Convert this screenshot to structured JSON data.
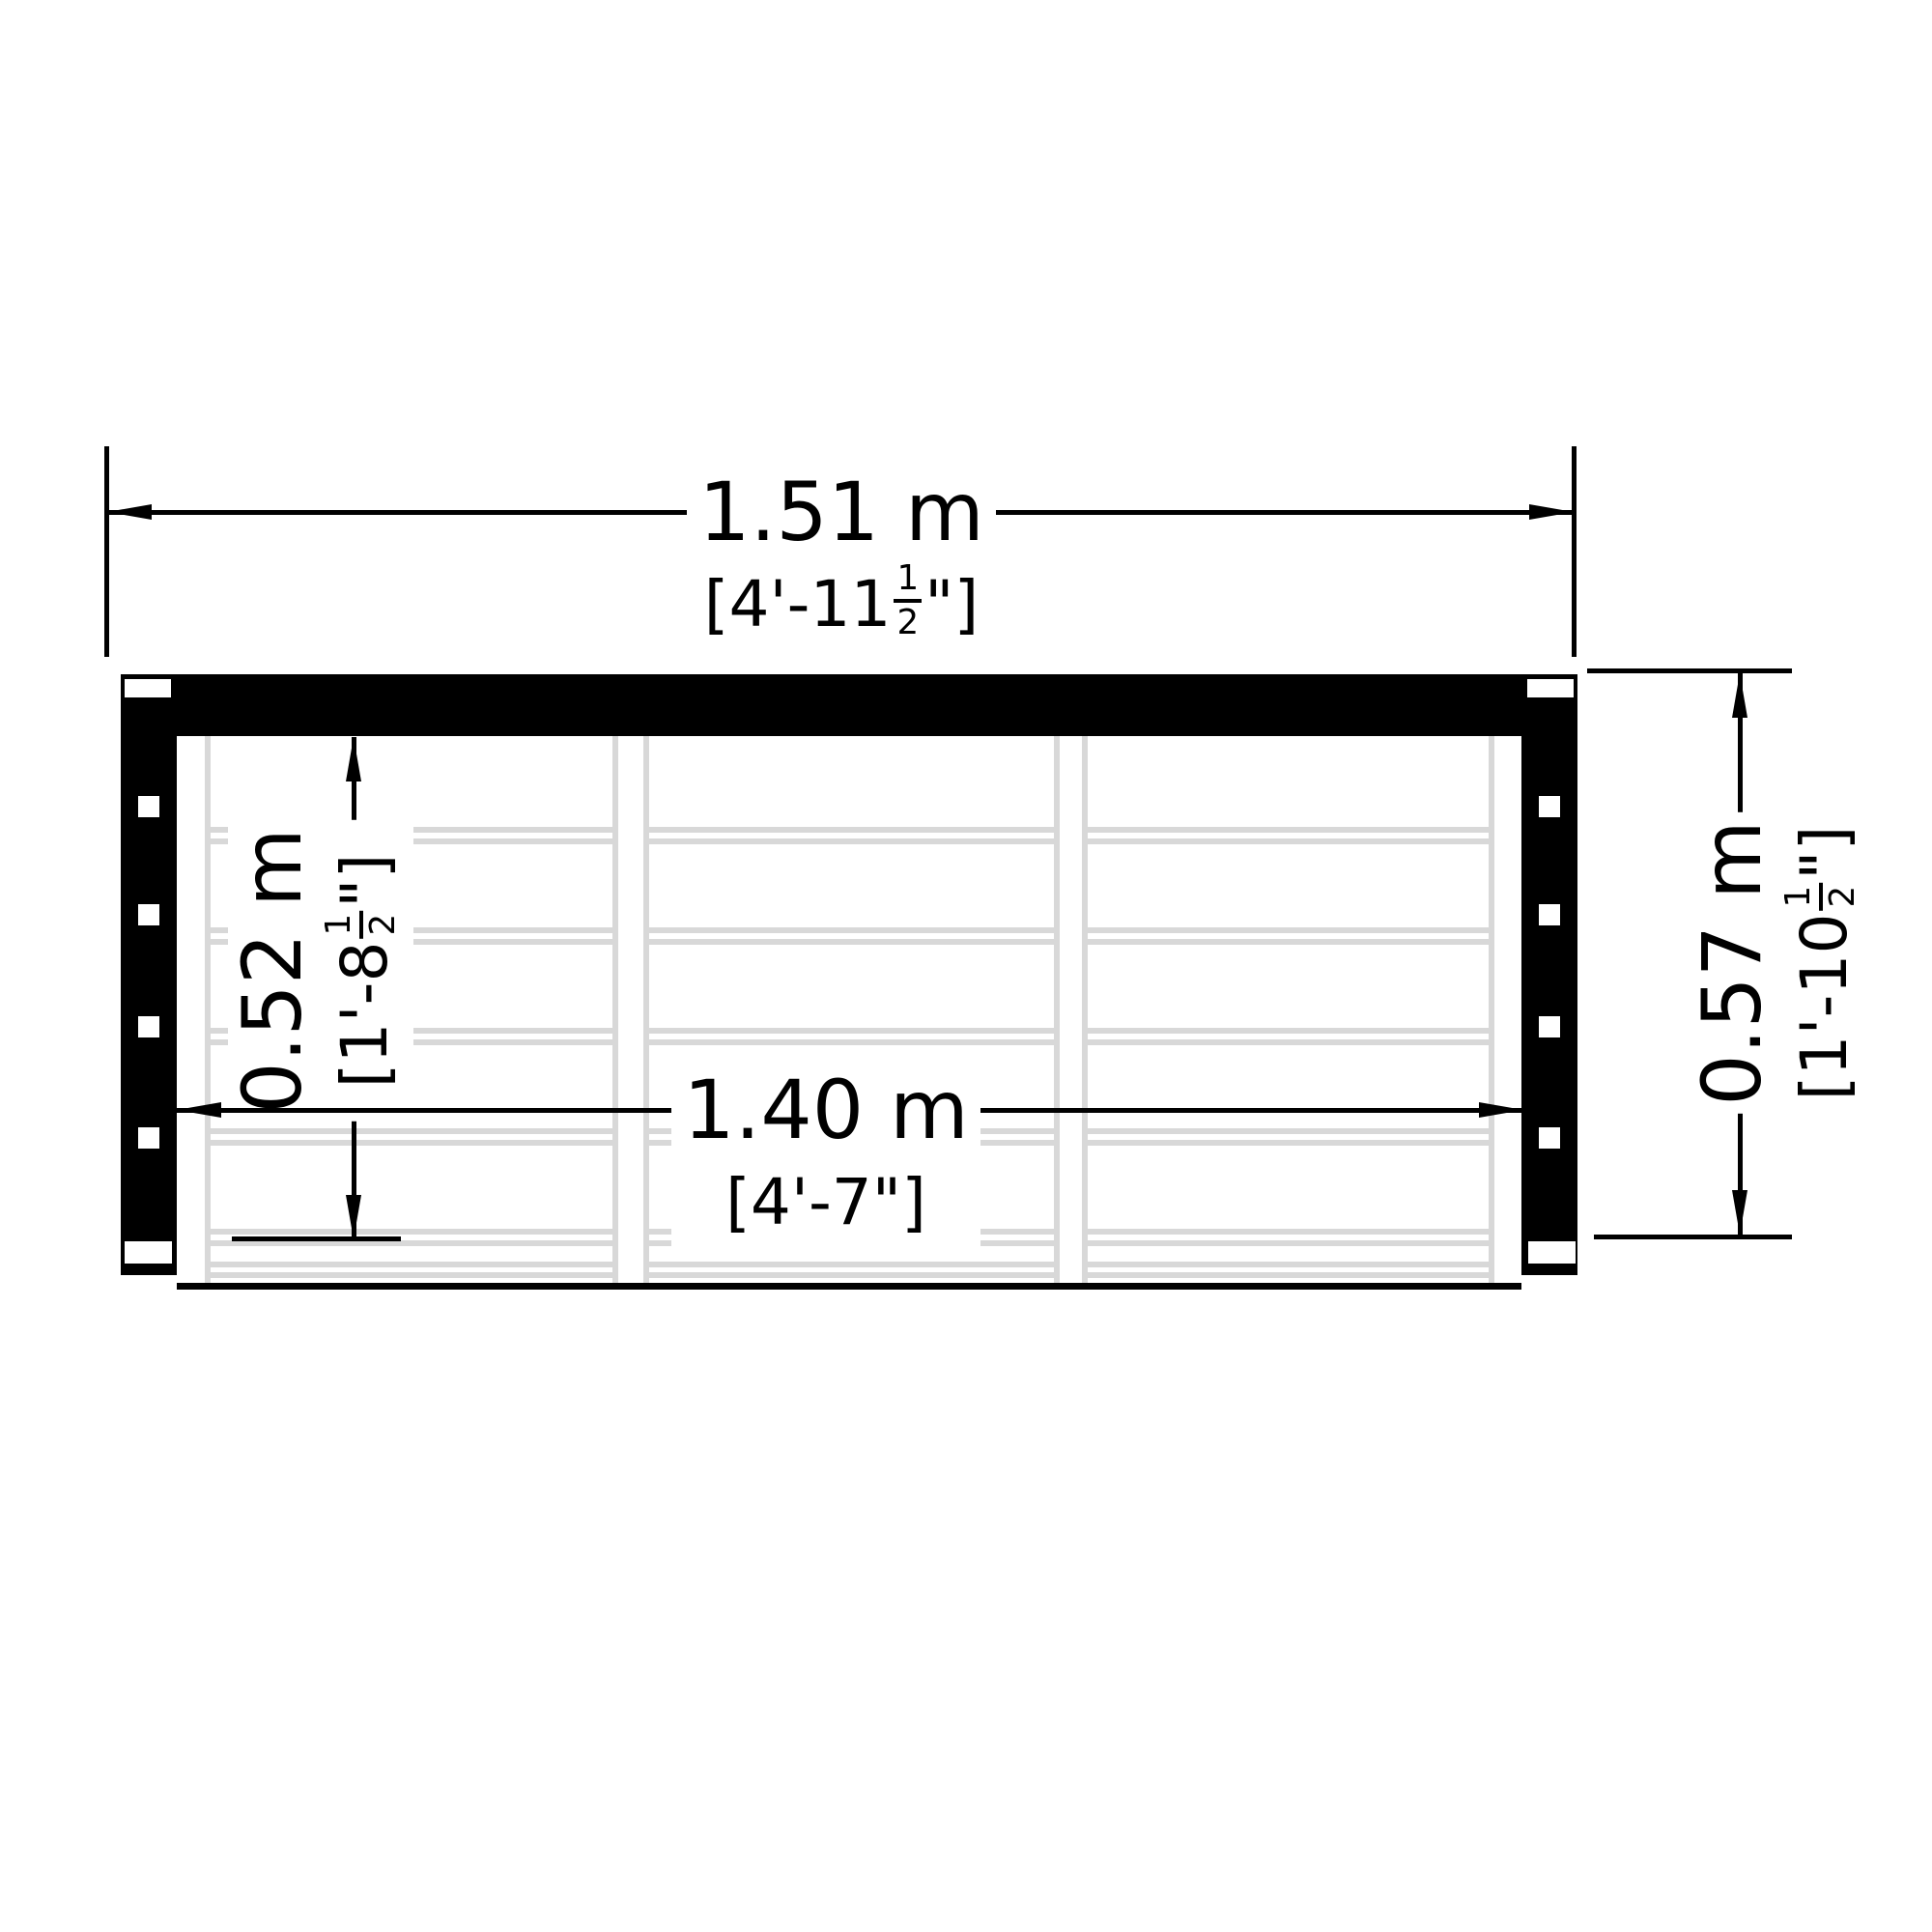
{
  "drawing": {
    "kind": "storage-unit floor plan with dimensions",
    "colors": {
      "line": "#000000",
      "plank_gray": "#d8d8d8",
      "background": "#ffffff"
    },
    "dimensions": {
      "overall_width": {
        "metric": "1.51 m",
        "imp_open": "[4'-11",
        "imp_frac_num": "1",
        "imp_frac_den": "2",
        "imp_close": "\"]"
      },
      "internal_width": {
        "metric": "1.40 m",
        "imp_open": "[4'-7",
        "imp_frac_num": "",
        "imp_frac_den": "",
        "imp_close": "\"]"
      },
      "internal_depth": {
        "metric": "0.52 m",
        "imp_open": "[1'-8",
        "imp_frac_num": "1",
        "imp_frac_den": "2",
        "imp_close": "\"]"
      },
      "overall_depth": {
        "metric": "0.57 m",
        "imp_open": "[1'-10",
        "imp_frac_num": "1",
        "imp_frac_den": "2",
        "imp_close": "\"]"
      }
    }
  }
}
